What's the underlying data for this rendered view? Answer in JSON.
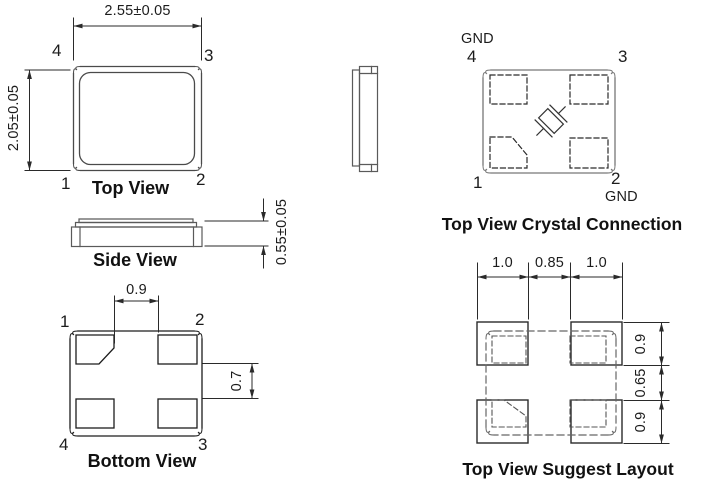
{
  "drawing": {
    "top_view": {
      "title": "Top View",
      "dim_width": "2.55±0.05",
      "dim_height": "2.05±0.05",
      "pin_top_left": "4",
      "pin_top_right": "3",
      "pin_bottom_left": "1",
      "pin_bottom_right": "2"
    },
    "side_view": {
      "title": "Side View",
      "dim_height": "0.55±0.05"
    },
    "bottom_view": {
      "title": "Bottom View",
      "dim_pad_gap_horizontal": "0.9",
      "dim_pad_gap_vertical": "0.7",
      "pin_top_left": "1",
      "pin_top_right": "2",
      "pin_bottom_left": "4",
      "pin_bottom_right": "3"
    },
    "crystal_connection": {
      "title": "Top View Crystal Connection",
      "gnd_top": "GND",
      "gnd_bottom": "GND",
      "pin_top_left": "4",
      "pin_top_right": "3",
      "pin_bottom_left": "1",
      "pin_bottom_right": "2"
    },
    "suggest_layout": {
      "title": "Top View Suggest Layout",
      "dim_pad_width_left": "1.0",
      "dim_pad_space": "0.85",
      "dim_pad_width_right": "1.0",
      "dim_pad_height_top": "0.9",
      "dim_pad_space_vertical": "0.65",
      "dim_pad_height_bottom": "0.9"
    },
    "colors": {
      "line_dark": "#1c1c1c",
      "line_gray": "#6f6f6f",
      "background": "#ffffff"
    }
  }
}
